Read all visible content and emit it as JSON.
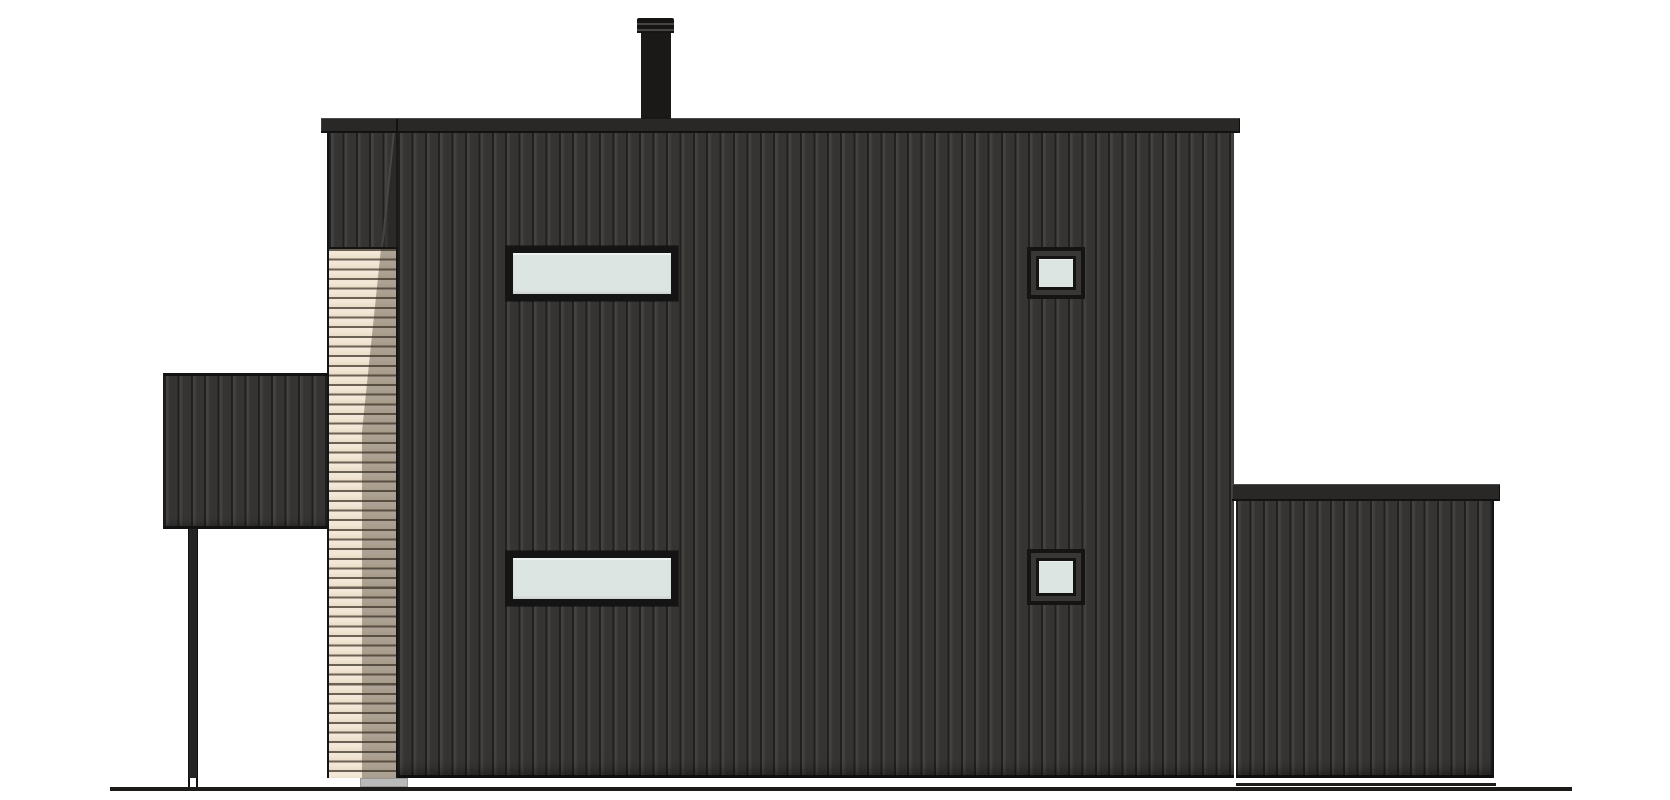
{
  "meta": {
    "kind": "architectural-elevation-drawing",
    "view": "side elevation of a two-storey house with dark vertical cladding, tan slat accent column, left canopy with post and lower right annex",
    "visible_text": []
  },
  "canvas": {
    "width": 1670,
    "height": 800
  },
  "palette": {
    "background": "#ffffff",
    "wall_face": "#353433",
    "wall_groove": "#21201f",
    "wall_edge_light": "#454340",
    "fascia": "#292827",
    "fascia_shadow": "#131212",
    "outline": "#151414",
    "chimney": "#1a1918",
    "chimney_cap": "#161514",
    "glass": "#dde5e2",
    "frame": "#151414",
    "frame_ring": "#393736",
    "slat_light": "#eadcc6",
    "slat_light_top": "#f3e8d8",
    "slat_line": "#6b6154",
    "slat_shadow": "rgba(58,47,38,0.38)",
    "footing": "#b9bab9",
    "ground": "#1c1b1a"
  },
  "elements": {
    "chimney_cap": {
      "x": 637,
      "y": 18,
      "w": 37,
      "h": 15
    },
    "chimney_body": {
      "x": 641,
      "y": 31,
      "w": 30,
      "h": 88
    },
    "main_fascia": {
      "x": 321,
      "y": 118,
      "w": 919,
      "h": 15
    },
    "fascia_seam": {
      "x": 396,
      "y": 119,
      "w": 2,
      "h": 13
    },
    "main_wall": {
      "x": 398,
      "y": 133,
      "w": 836,
      "h": 645
    },
    "column_upper": {
      "x": 327,
      "y": 133,
      "w": 71,
      "h": 114
    },
    "column_slats": {
      "x": 327,
      "y": 247,
      "w": 71,
      "h": 531
    },
    "canopy_roof": {
      "x": 163,
      "y": 373,
      "w": 164,
      "h": 156
    },
    "canopy_post": {
      "x": 188,
      "y": 529,
      "w": 10,
      "h": 249
    },
    "post_foot": {
      "x": 188,
      "y": 778,
      "w": 10,
      "h": 9
    },
    "window_left_top": {
      "x": 506,
      "y": 246,
      "w": 172,
      "h": 55
    },
    "window_left_bottom": {
      "x": 506,
      "y": 551,
      "w": 172,
      "h": 55
    },
    "window_right_top": {
      "x": 1027,
      "y": 247,
      "w": 58,
      "h": 52
    },
    "window_right_bottom": {
      "x": 1027,
      "y": 549,
      "w": 58,
      "h": 56
    },
    "annex_fascia": {
      "x": 1232,
      "y": 484,
      "w": 268,
      "h": 17
    },
    "annex_wall": {
      "x": 1236,
      "y": 501,
      "w": 258,
      "h": 277
    },
    "annex_base_line": {
      "x": 1236,
      "y": 783,
      "w": 260,
      "h": 3
    },
    "footing_block": {
      "x": 360,
      "y": 778,
      "w": 48,
      "h": 9
    },
    "ground_line": {
      "x": 110,
      "y": 787,
      "w": 1462,
      "h": 4
    }
  }
}
